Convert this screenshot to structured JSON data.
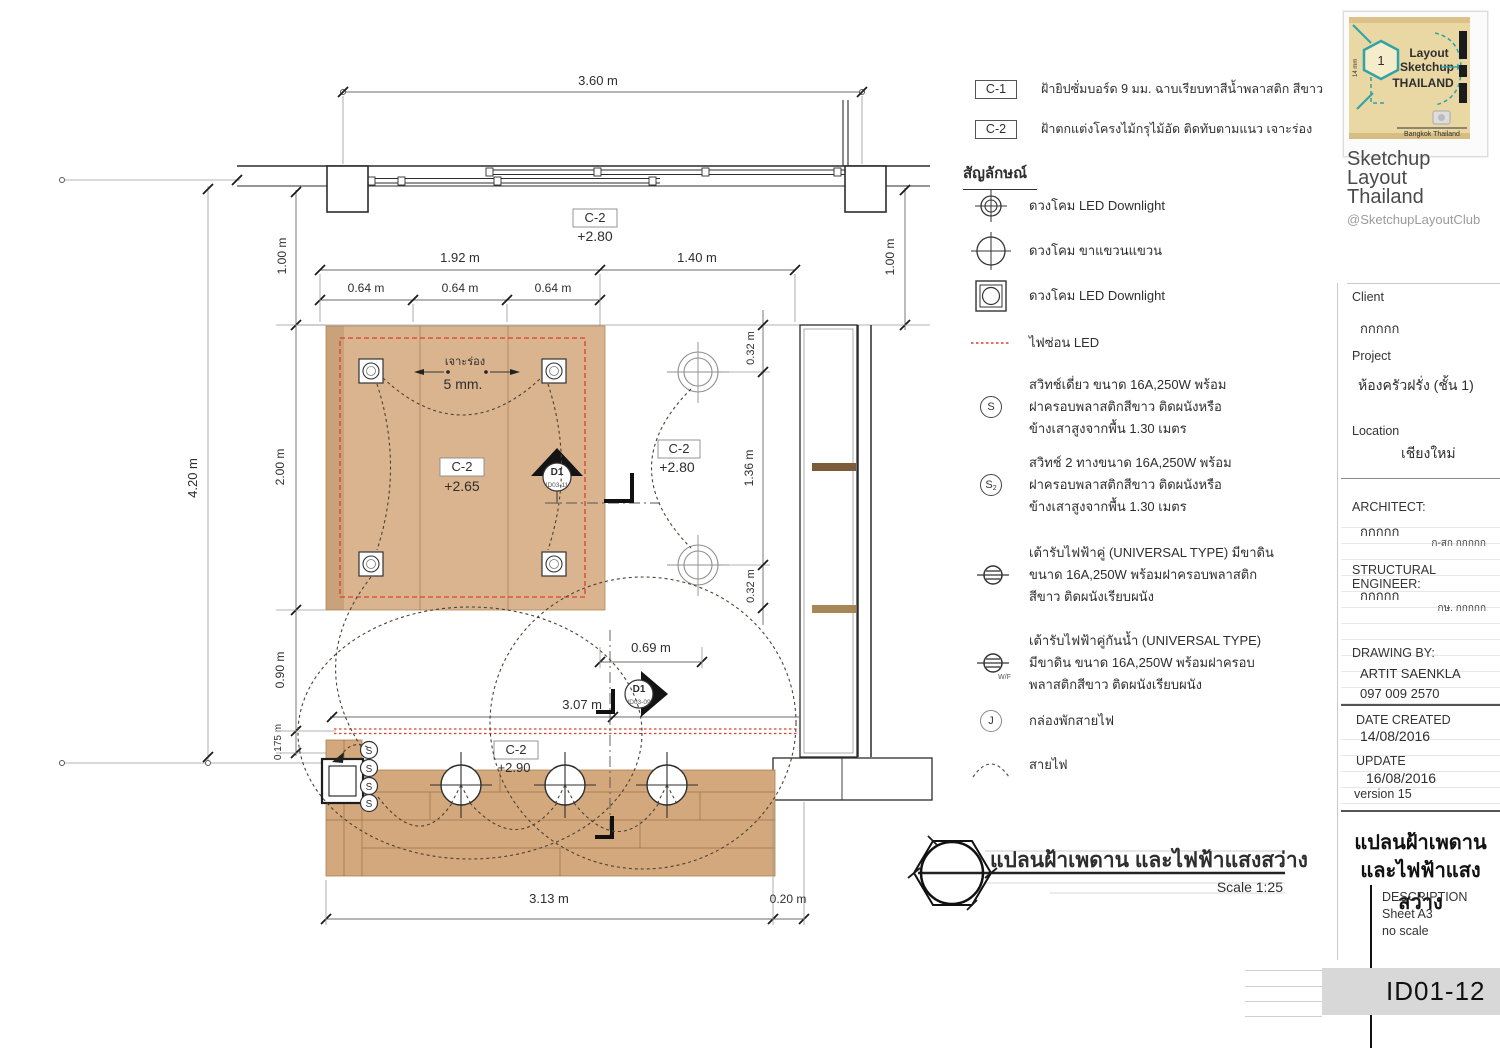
{
  "colors": {
    "wood_ceiling": "#d9b48e",
    "wood_counter": "#d2a87c",
    "led_red": "#d8402e",
    "logo_teal": "#2fa3a5",
    "logo_red": "#c0392b",
    "band_gray": "#d8d8d8"
  },
  "plan": {
    "dims": {
      "top_width": "3.60 m",
      "left_total": "4.20 m",
      "one_left": "1.00 m",
      "one_right": "1.00 m",
      "span_a": "1.92 m",
      "span_b": "1.40 m",
      "sub_span": "0.64 m",
      "wood_depth": "2.00 m",
      "open_depth": "0.90 m",
      "ledge": "0.175 m",
      "right_a": "0.32 m",
      "right_b": "1.36 m",
      "right_c": "0.32 m",
      "island": "0.69 m",
      "run": "3.07 m",
      "bottom_a": "3.13 m",
      "bottom_b": "0.20 m"
    },
    "labels": {
      "c2": "C-2",
      "lvl_265": "+2.65",
      "lvl_280": "+2.80",
      "lvl_290": "+2.90",
      "groove_name": "เจาะร่อง",
      "groove_size": "5 mm.",
      "d1": "D1",
      "d1_top_ref": "ID03-11",
      "d1_bottom_ref": "ID03-09",
      "switch_glyph": "S"
    },
    "title": "แปลนฝ้าเพดาน และไฟฟ้าแสงสว่าง",
    "scale": "Scale 1:25"
  },
  "finish_schedule": [
    {
      "code": "C-1",
      "desc": "ฝ้ายิปซั่มบอร์ด 9 มม. ฉาบเรียบทาสีน้ำพลาสติก สีขาว"
    },
    {
      "code": "C-2",
      "desc": "ฝ้าตกแต่งโครงไม้กรุไม้อัด ติดทับตามแนว เจาะร่อง"
    }
  ],
  "legend": {
    "header": "สัญลักษณ์",
    "items": [
      {
        "icon": "downlight-recessed",
        "label": "ดวงโคม LED Downlight"
      },
      {
        "icon": "pendant-lamp",
        "label": "ดวงโคม ขาแขวนแขวน"
      },
      {
        "icon": "downlight-square",
        "label": "ดวงโคม LED Downlight"
      },
      {
        "icon": "led-strip",
        "label": "ไฟซ่อน LED"
      },
      {
        "icon": "switch-single",
        "glyph": "S",
        "label": "สวิทช์เดี่ยว ขนาด 16A,250W พร้อม\nฝาครอบพลาสติกสีขาว ติดผนังหรือ\nข้างเสาสูงจากพื้น 1.30 เมตร"
      },
      {
        "icon": "switch-two-way",
        "glyph": "S",
        "sub": "2",
        "label": "สวิทช์ 2 ทางขนาด 16A,250W พร้อม\nฝาครอบพลาสติกสีขาว ติดผนังหรือ\nข้างเสาสูงจากพื้น 1.30 เมตร"
      },
      {
        "icon": "receptacle-duplex",
        "label": "เต้ารับไฟฟ้าคู่ (UNIVERSAL TYPE) มีขาดิน\nขนาด 16A,250W พร้อมฝาครอบพลาสติก\nสีขาว ติดผนังเรียบผนัง"
      },
      {
        "icon": "receptacle-waterproof",
        "sub": "W/F",
        "label": "เต้ารับไฟฟ้าคู่กันน้ำ (UNIVERSAL TYPE)\nมีขาดิน ขนาด 16A,250W พร้อมฝาครอบ\nพลาสติกสีขาว ติดผนังเรียบผนัง"
      },
      {
        "icon": "junction-box",
        "glyph": "J",
        "label": "กล่องพักสายไฟ"
      },
      {
        "icon": "wire-arc",
        "label": "สายไฟ"
      }
    ]
  },
  "sidebar": {
    "brand": {
      "logo_number": "1",
      "logo_line1": "Layout",
      "logo_line2": "Sketchup",
      "logo_line3": "THAILAND",
      "logo_caption": "Bangkok Thailand",
      "name_line1": "Sketchup",
      "name_line2": "Layout",
      "name_line3": "Thailand",
      "handle": "@SketchupLayoutClub"
    },
    "client_label": "Client",
    "client_value": "กกกกก",
    "project_label": "Project",
    "project_value": "ห้องครัวฝรั่ง (ชั้น 1)",
    "location_label": "Location",
    "location_value": "เชียงใหม่",
    "architect_label": "ARCHITECT:",
    "architect_value": "กกกกก",
    "architect_note": "ก-สก กกกกก",
    "engineer_label": "STRUCTURAL ENGINEER:",
    "engineer_value": "กกกกก",
    "engineer_note": "กษ. กกกกก",
    "drawing_by_label": "DRAWING BY:",
    "drawing_by_name": "ARTIT SAENKLA",
    "drawing_by_phone": "097 009 2570",
    "date_created_label": "DATE CREATED",
    "date_created_value": "14/08/2016",
    "update_label": "UPDATE",
    "update_value": "16/08/2016",
    "version": "version 15",
    "sheet_title_line1": "แปลนฝ้าเพดาน",
    "sheet_title_line2": "และไฟฟ้าแสงสว่าง",
    "description_label": "DESCRIPTION",
    "sheet_note": "Sheet  A3",
    "scale_note": "no scale",
    "sheet_id": "ID01-12"
  }
}
